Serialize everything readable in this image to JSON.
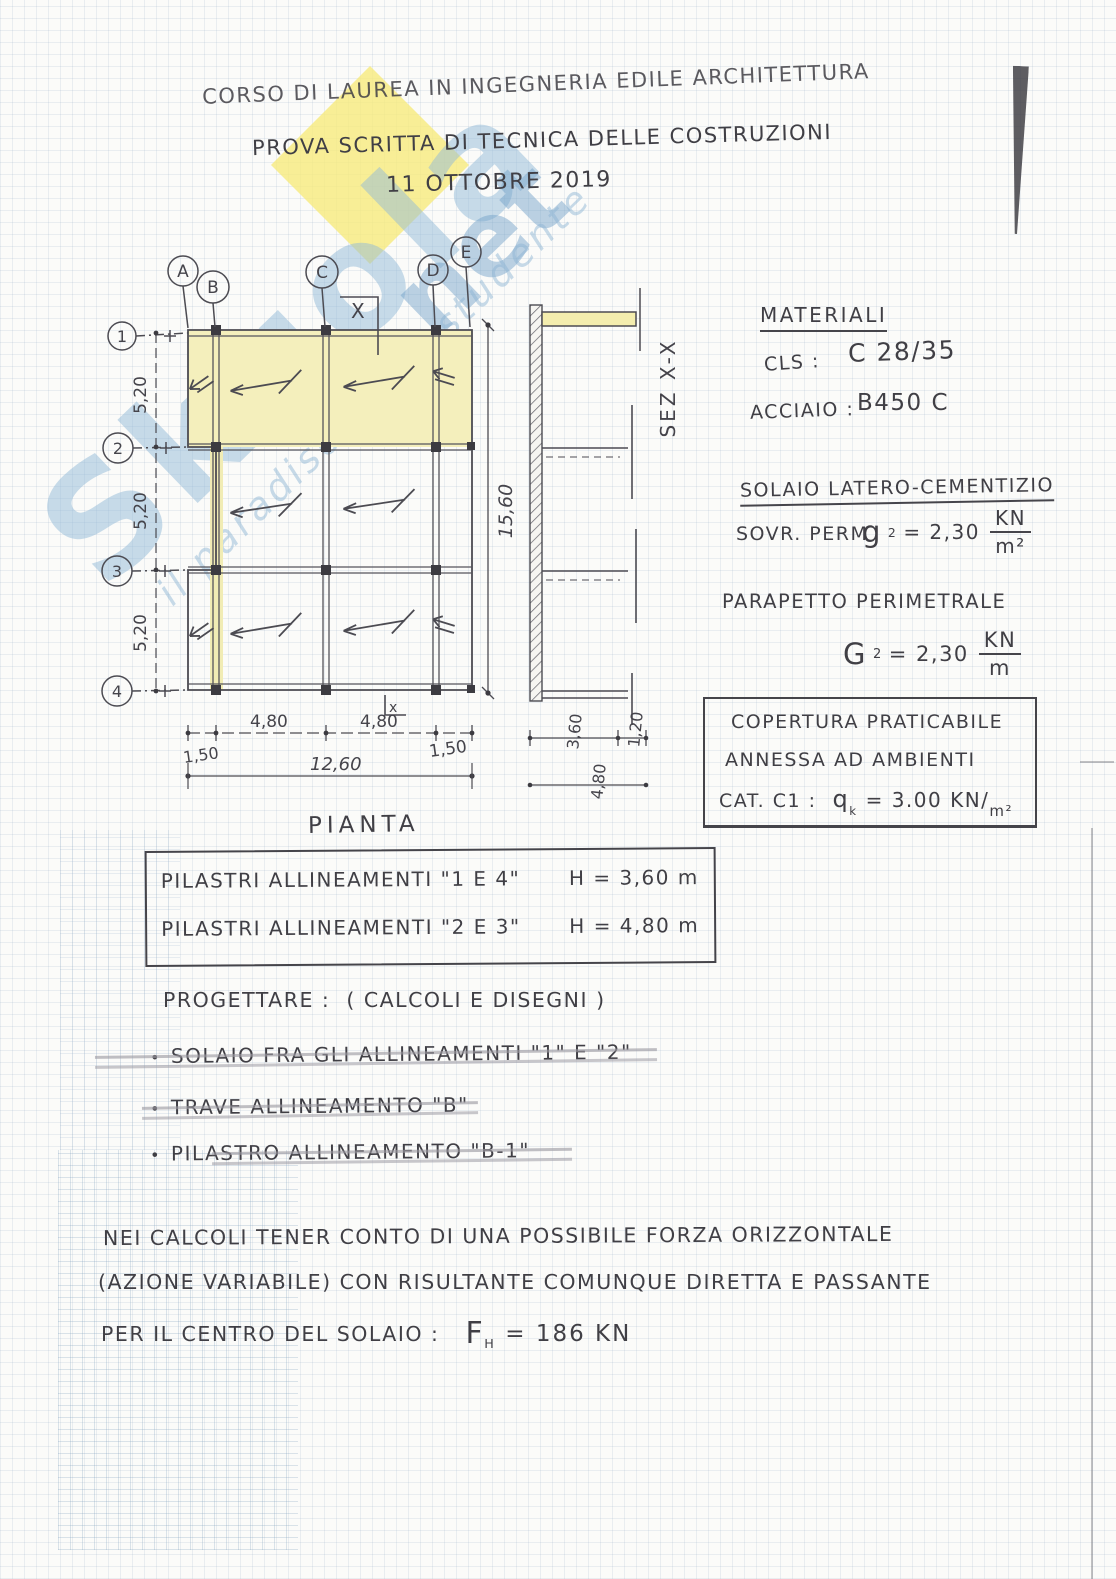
{
  "watermark": {
    "brand": "Skuola",
    "net": ".net",
    "tagline": "il paradiso dello studente"
  },
  "header": {
    "line1": "CORSO DI LAUREA IN INGEGNERIA EDILE ARCHITETTURA",
    "line2": "PROVA SCRITTA DI TECNICA DELLE COSTRUZIONI",
    "line3": "11 OTTOBRE 2019"
  },
  "plan": {
    "label": "PIANTA",
    "grid_columns": [
      "A",
      "B",
      "C",
      "D",
      "E"
    ],
    "grid_rows": [
      "1",
      "2",
      "3",
      "4"
    ],
    "row_dims": [
      "5,20",
      "5,20",
      "5,20"
    ],
    "total_height_dim": "15,60",
    "bottom_dims": [
      "1,50",
      "4,80",
      "4,80",
      "1,50"
    ],
    "total_width_dim": "12,60",
    "section_cut_label": "X",
    "section_cut_label_small": "x"
  },
  "section": {
    "label": "SEZ X-X",
    "dims": [
      "3,60",
      "1,20",
      "4,80"
    ]
  },
  "materials": {
    "title": "MATERIALI",
    "cls_label": "CLS :",
    "cls_value": "C 28/35",
    "steel_label": "ACCIAIO :",
    "steel_value": "B450 C"
  },
  "solaio": {
    "title": "SOLAIO LATERO-CEMENTIZIO",
    "perm_label": "SOVR. PERM",
    "sym": "g",
    "sym_sub": "2",
    "eq": "= 2,30",
    "unit_num": "KN",
    "unit_den": "m²"
  },
  "parapetto": {
    "title": "PARAPETTO PERIMETRALE",
    "sym": "G",
    "sym_sub": "2",
    "eq": "= 2,30",
    "unit_num": "KN",
    "unit_den": "m"
  },
  "copertura": {
    "line1": "COPERTURA PRATICABILE",
    "line2": "ANNESSA AD AMBIENTI",
    "cat_label": "CAT. C1 :",
    "sym": "q",
    "sym_sub": "k",
    "value": "= 3.00 KN/",
    "unit_den": "m²"
  },
  "pilastri": {
    "row1_text": "PILASTRI ALLINEAMENTI \"1 E 4\"",
    "row1_h": "H = 3,60 m",
    "row2_text": "PILASTRI ALLINEAMENTI \"2 E 3\"",
    "row2_h": "H = 4,80 m"
  },
  "progettare": {
    "title": "PROGETTARE :",
    "subtitle": "( CALCOLI  E DISEGNI )",
    "bullet": "•",
    "items": [
      "SOLAIO FRA GLI ALLINEAMENTI \"1\" E \"2\"",
      "TRAVE ALLINEAMENTO \"B\"",
      "PILASTRO ALLINEAMENTO \"B-1\""
    ]
  },
  "note": {
    "line1": "NEI CALCOLI TENER CONTO DI UNA POSSIBILE FORZA ORIZZONTALE",
    "line2": "(AZIONE VARIABILE) CON RISULTANTE COMUNQUE DIRETTA E PASSANTE",
    "line3": "PER IL CENTRO DEL SOLAIO :",
    "f_sym": "F",
    "f_sub": "H",
    "f_val": "= 186 KN"
  },
  "colors": {
    "ink": "#45444b",
    "highlight": "#f4efbc",
    "watermark_blue": "#92bad8",
    "watermark_yellow": "#f7ea7a",
    "pencil": "#9c9aa2"
  }
}
